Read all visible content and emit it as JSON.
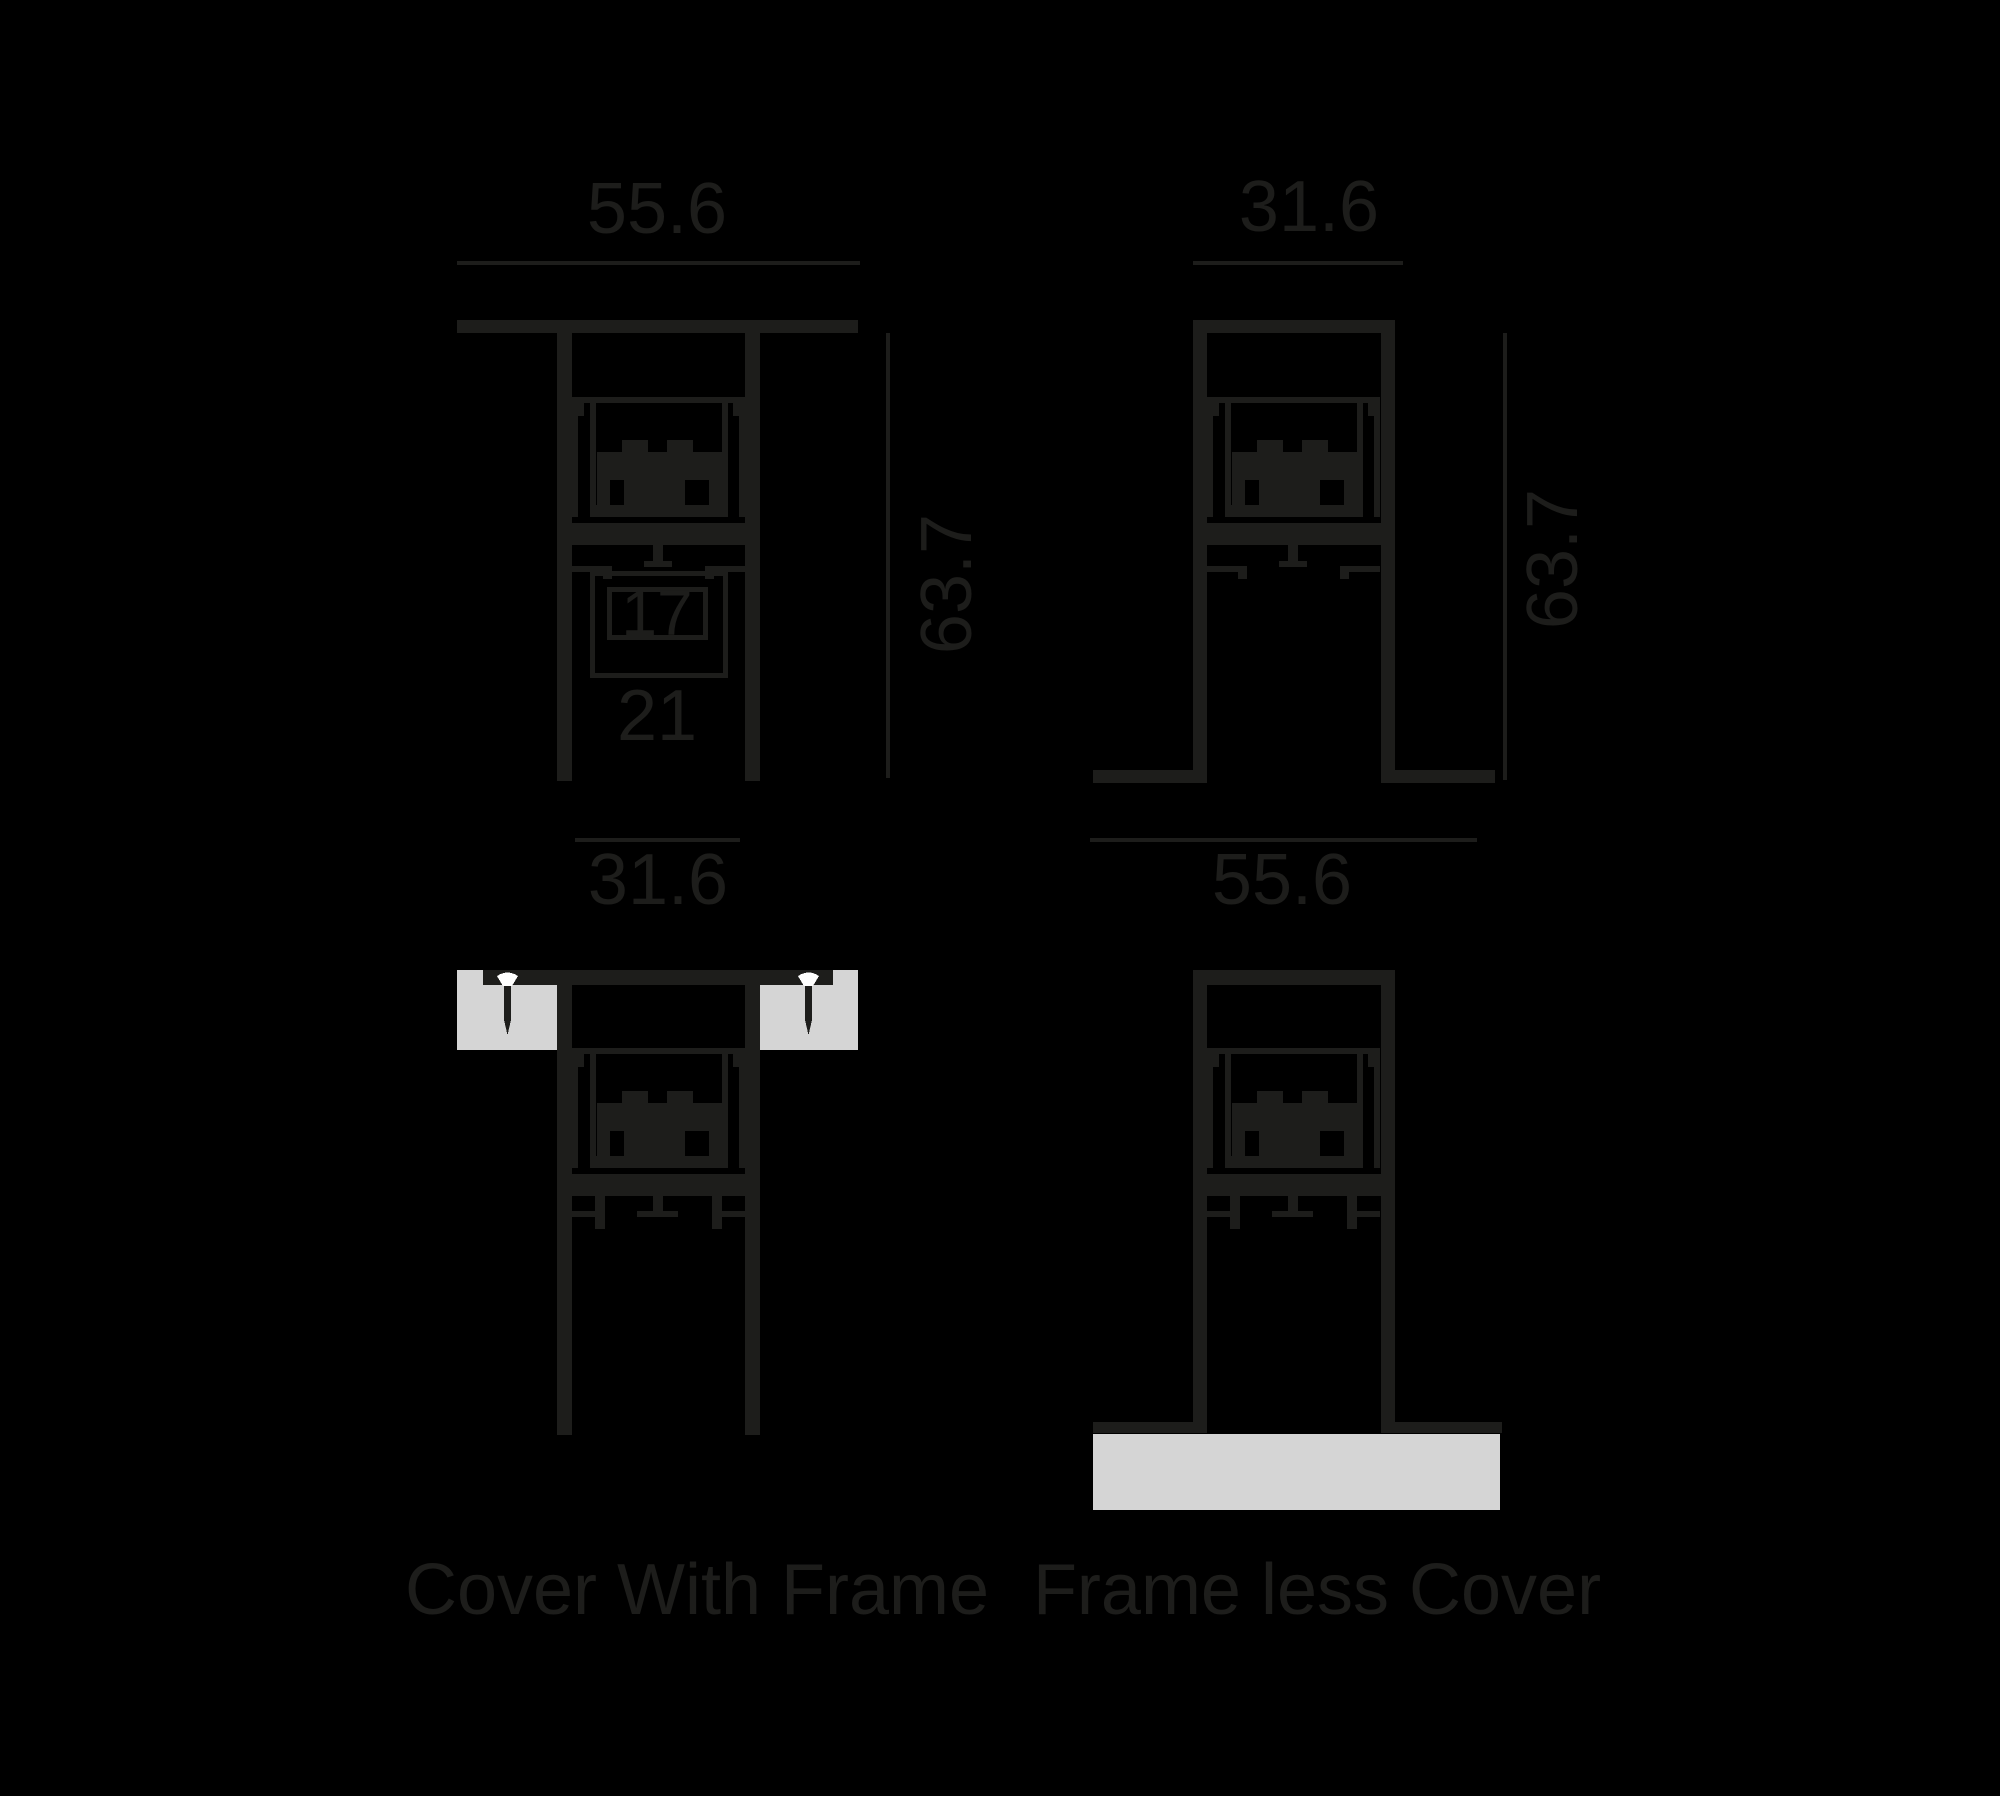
{
  "colors": {
    "background": "#000000",
    "ink": "#1d1d1b",
    "surface": "#d5d5d5",
    "screw_head": "#ffffff"
  },
  "top_left_section": {
    "width_top": "55.6",
    "height_side": "63.7",
    "slot_inner_width": "17",
    "slot_outer_width": "21",
    "width_bottom": "31.6"
  },
  "top_right_section": {
    "width_top": "31.6",
    "height_side": "63.7",
    "width_bottom": "55.6"
  },
  "bottom_left_view": {
    "caption": "Cover With Frame"
  },
  "bottom_right_view": {
    "caption": "Frame less Cover"
  }
}
